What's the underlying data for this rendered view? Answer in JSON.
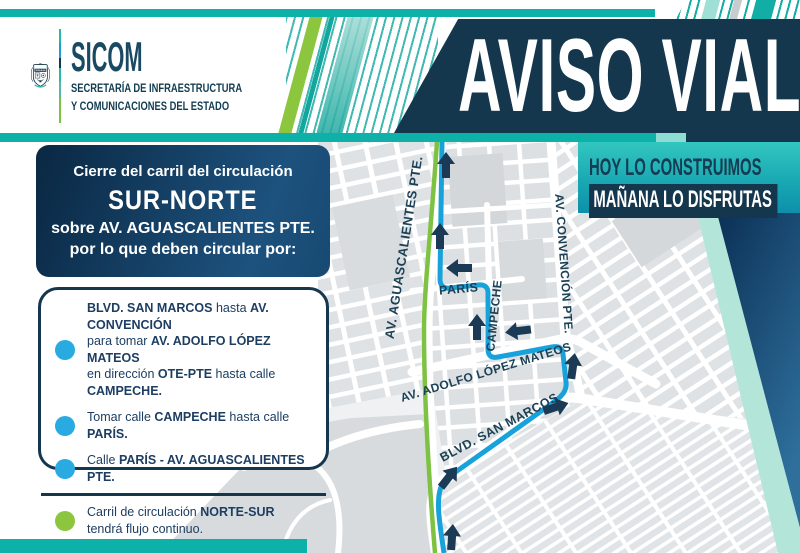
{
  "header": {
    "title": "AVISO VIAL",
    "logo": {
      "acronym": "SICOM",
      "secretariat_line1": "SECRETARÍA DE INFRAESTRUCTURA",
      "secretariat_line2": "Y COMUNICACIONES DEL ESTADO",
      "crest_motto_top": "TERRA.BONA"
    }
  },
  "slogan": {
    "line1": "HOY LO CONSTRUIMOS",
    "line2": "MAÑANA LO DISFRUTAS"
  },
  "advisory": {
    "intro_line1": "Cierre del carril del circulación",
    "intro_highlight": "SUR-NORTE",
    "intro_line3": "sobre AV. AGUASCALIENTES PTE.",
    "intro_line4": "por lo que deben circular por:",
    "detour_steps": [
      {
        "bullet_color": "#29abe2",
        "segments": [
          {
            "t": "BLVD. SAN MARCOS",
            "b": true
          },
          {
            "t": " hasta ",
            "b": false
          },
          {
            "t": "AV. CONVENCIÓN",
            "b": true
          },
          {
            "t": "\npara tomar ",
            "b": false
          },
          {
            "t": "AV. ADOLFO LÓPEZ MATEOS",
            "b": true
          },
          {
            "t": "\nen dirección ",
            "b": false
          },
          {
            "t": "OTE-PTE",
            "b": true
          },
          {
            "t": " hasta calle ",
            "b": false
          },
          {
            "t": "CAMPECHE.",
            "b": true
          }
        ]
      },
      {
        "bullet_color": "#29abe2",
        "segments": [
          {
            "t": "Tomar calle ",
            "b": false
          },
          {
            "t": "CAMPECHE",
            "b": true
          },
          {
            "t": " hasta calle ",
            "b": false
          },
          {
            "t": "PARÍS.",
            "b": true
          }
        ]
      },
      {
        "bullet_color": "#29abe2",
        "segments": [
          {
            "t": "Calle ",
            "b": false
          },
          {
            "t": "PARÍS - AV. AGUASCALIENTES PTE.",
            "b": true
          }
        ]
      }
    ],
    "continuous_note": [
      {
        "bullet_color": "#8cc63f",
        "segments": [
          {
            "t": "Carril de circulación ",
            "b": false
          },
          {
            "t": "NORTE-SUR",
            "b": true
          },
          {
            "t": "\ntendrá flujo continuo.",
            "b": false
          }
        ]
      }
    ]
  },
  "map": {
    "street_labels": {
      "aguascalientes": "AV. AGUASCALIENTES PTE.",
      "paris": "PARÍS",
      "campeche": "CAMPECHE",
      "convencion": "AV. CONVENCIÓN PTE.",
      "lopez_mateos": "AV. ADOLFO LÓPEZ MATEOS",
      "san_marcos": "BLVD. SAN MARCOS"
    },
    "legend": {
      "detour_route_color": "#17a2db",
      "continuous_flow_color": "#7dc242",
      "direction_arrow_color": "#1b3a55"
    }
  },
  "colors": {
    "navy": "#15374e",
    "teal": "#0db1a8",
    "mint": "#b3e6d8",
    "bullet_blue": "#29abe2",
    "bullet_green": "#8cc63f",
    "text_navy": "#1d3e62"
  }
}
